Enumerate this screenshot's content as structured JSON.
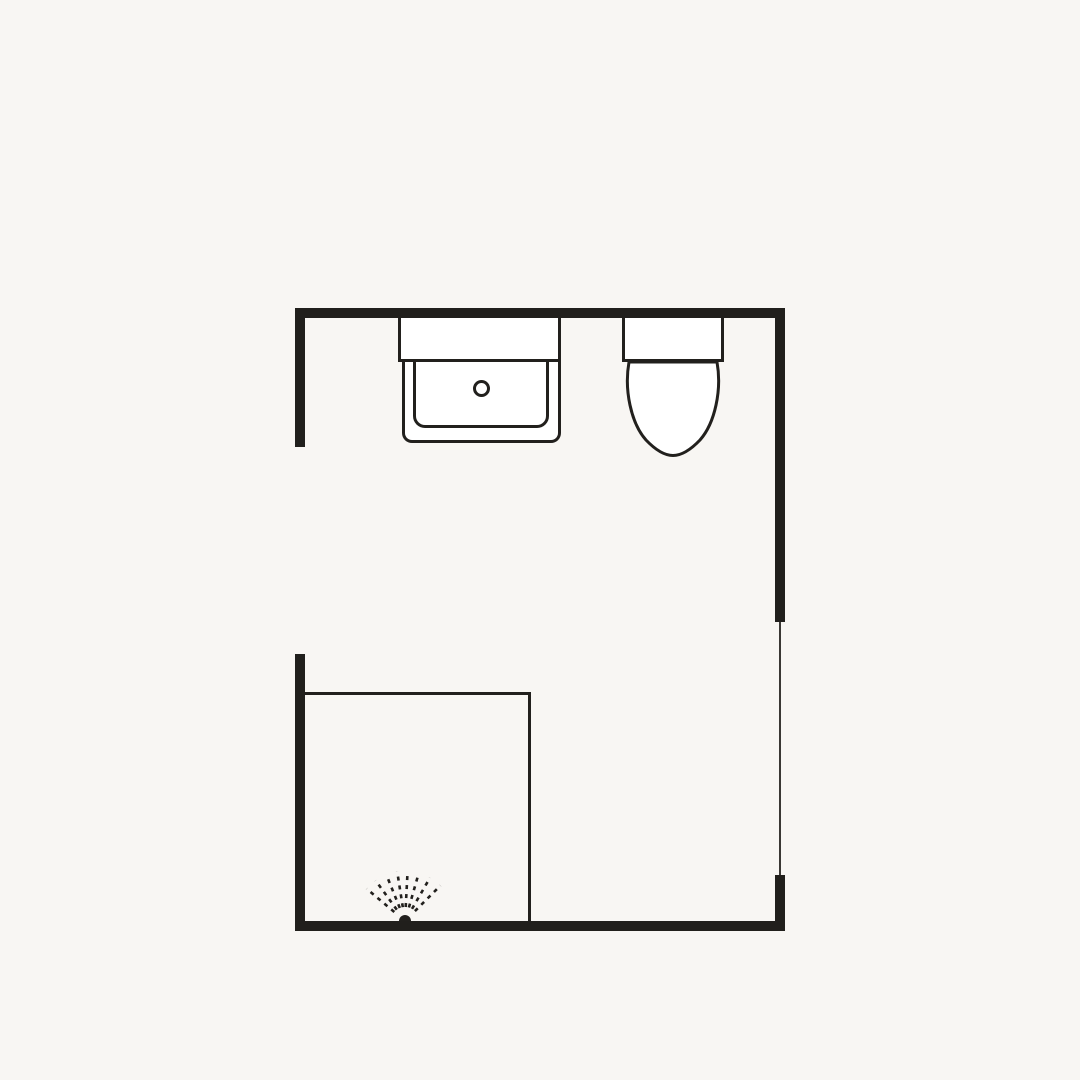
{
  "colors": {
    "background": "#f8f6f3",
    "wall": "#211f1c",
    "outline": "#22201d",
    "door_line": "#3a3834",
    "fixture_fill": "#ffffff"
  },
  "plan": {
    "symbols": [
      {
        "name": "vanity-sink-symbol"
      },
      {
        "name": "faucet-hole-symbol"
      },
      {
        "name": "toilet-symbol"
      },
      {
        "name": "shower-enclosure-symbol"
      },
      {
        "name": "shower-spray-symbol"
      },
      {
        "name": "door-opening-symbol"
      }
    ]
  }
}
